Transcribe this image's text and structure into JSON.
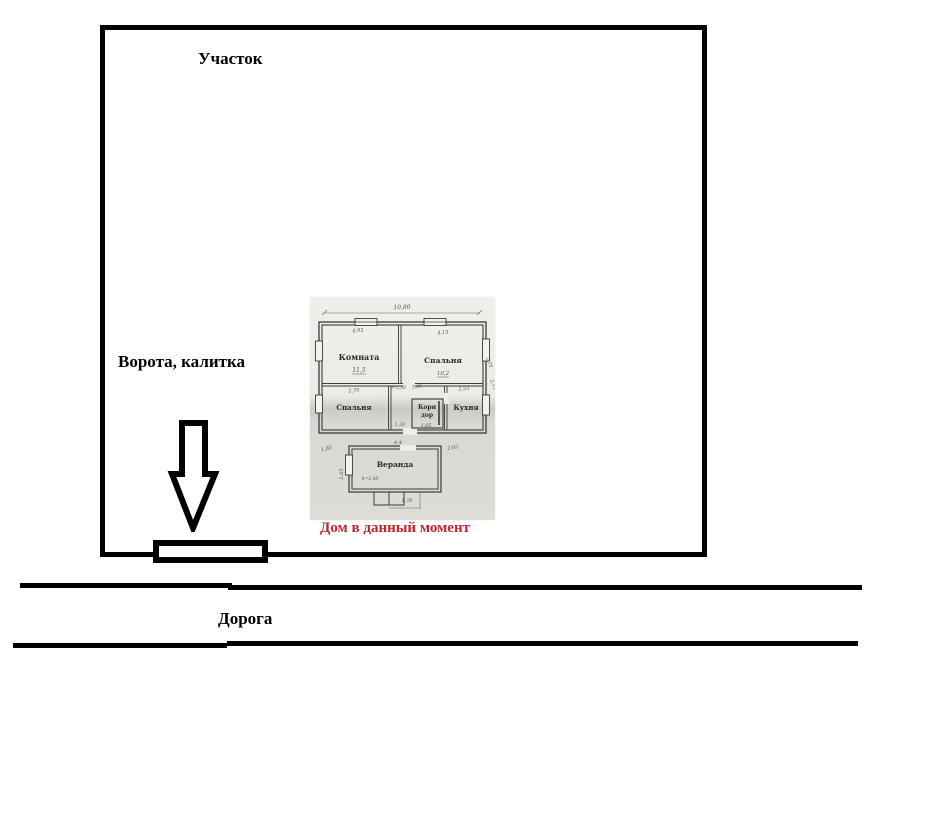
{
  "scene": {
    "plot_label": "Участок",
    "gate_label": "Ворота, калитка",
    "road_label": "Дорога",
    "caption": "Дом в данный момент",
    "caption_color": "#c0262d",
    "line_color": "#000000"
  },
  "floor_plan": {
    "rooms": {
      "living": "Комната",
      "bedroom_top": "Спальня",
      "bedroom_bottom": "Спальня",
      "corridor_line1": "Кори",
      "corridor_line2": "дор",
      "kitchen": "Кухня",
      "veranda": "Веранда"
    },
    "areas": {
      "living": "11,5",
      "bedroom_top": "10,2"
    },
    "dims": {
      "overall_width": "10,80",
      "living_width": "4,93",
      "bedroom_top_width": "4,15",
      "bedroom_bottom_width": "2,70",
      "corridor_width": "3,08",
      "corridor_height": "h=2,50",
      "kitchen_width": "2,53",
      "corridor_inner": "1,65",
      "corridor_door": "1,20",
      "veranda_offset_left": "1,85",
      "veranda_offset_right": "2,65",
      "veranda_width": "4,4",
      "veranda_depth": "2,65",
      "veranda_height": "h=2,45",
      "porch_width": "1,78",
      "side_right_a": "2,75",
      "side_right_b": "2,13"
    }
  }
}
